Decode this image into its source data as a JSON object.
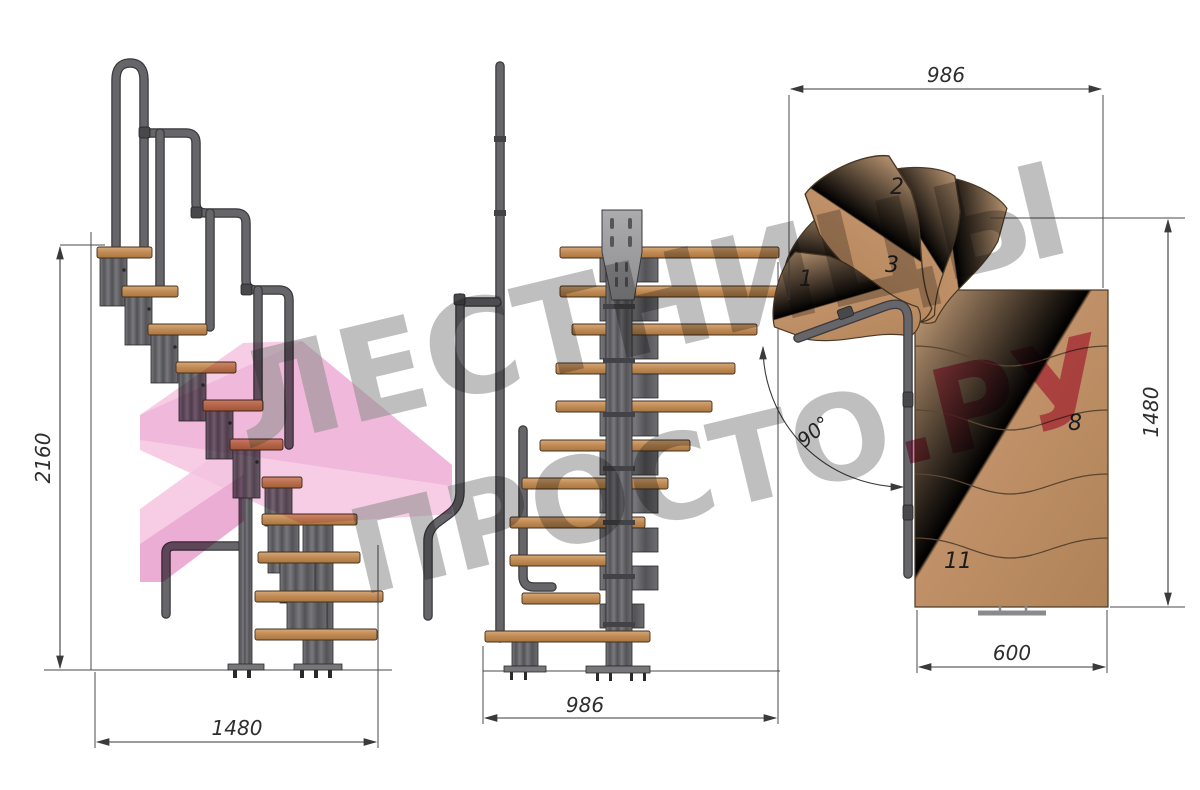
{
  "drawing": {
    "type": "modular-staircase-technical-drawing",
    "views": [
      "side-elevation",
      "front-elevation",
      "plan"
    ]
  },
  "views": {
    "side_elevation": {
      "dims": {
        "height": "2160",
        "width": "1480"
      }
    },
    "front_elevation": {
      "dims": {
        "width": "986"
      }
    },
    "plan": {
      "dims": {
        "width_top": "986",
        "depth_right": "1480",
        "width_bottom": "600",
        "turn_angle": "90°"
      },
      "step_labels": [
        "1",
        "2",
        "3",
        "8",
        "11"
      ]
    }
  },
  "watermark": {
    "line1": "ЛЕСТНИЦЫ",
    "line2": "ПРОСТО",
    "line2_accent": ".РУ",
    "text_color": "#8a8a8a",
    "accent_color": "#d83d78",
    "ribbon_color": "#f5c4e1"
  },
  "colors": {
    "wood": "#c59a72",
    "wood_dark": "#a87c52",
    "metal": "#5a5a5d",
    "metal_light": "#9b9b9d",
    "dimension_line": "#3a3a3c",
    "background": "#ffffff"
  }
}
